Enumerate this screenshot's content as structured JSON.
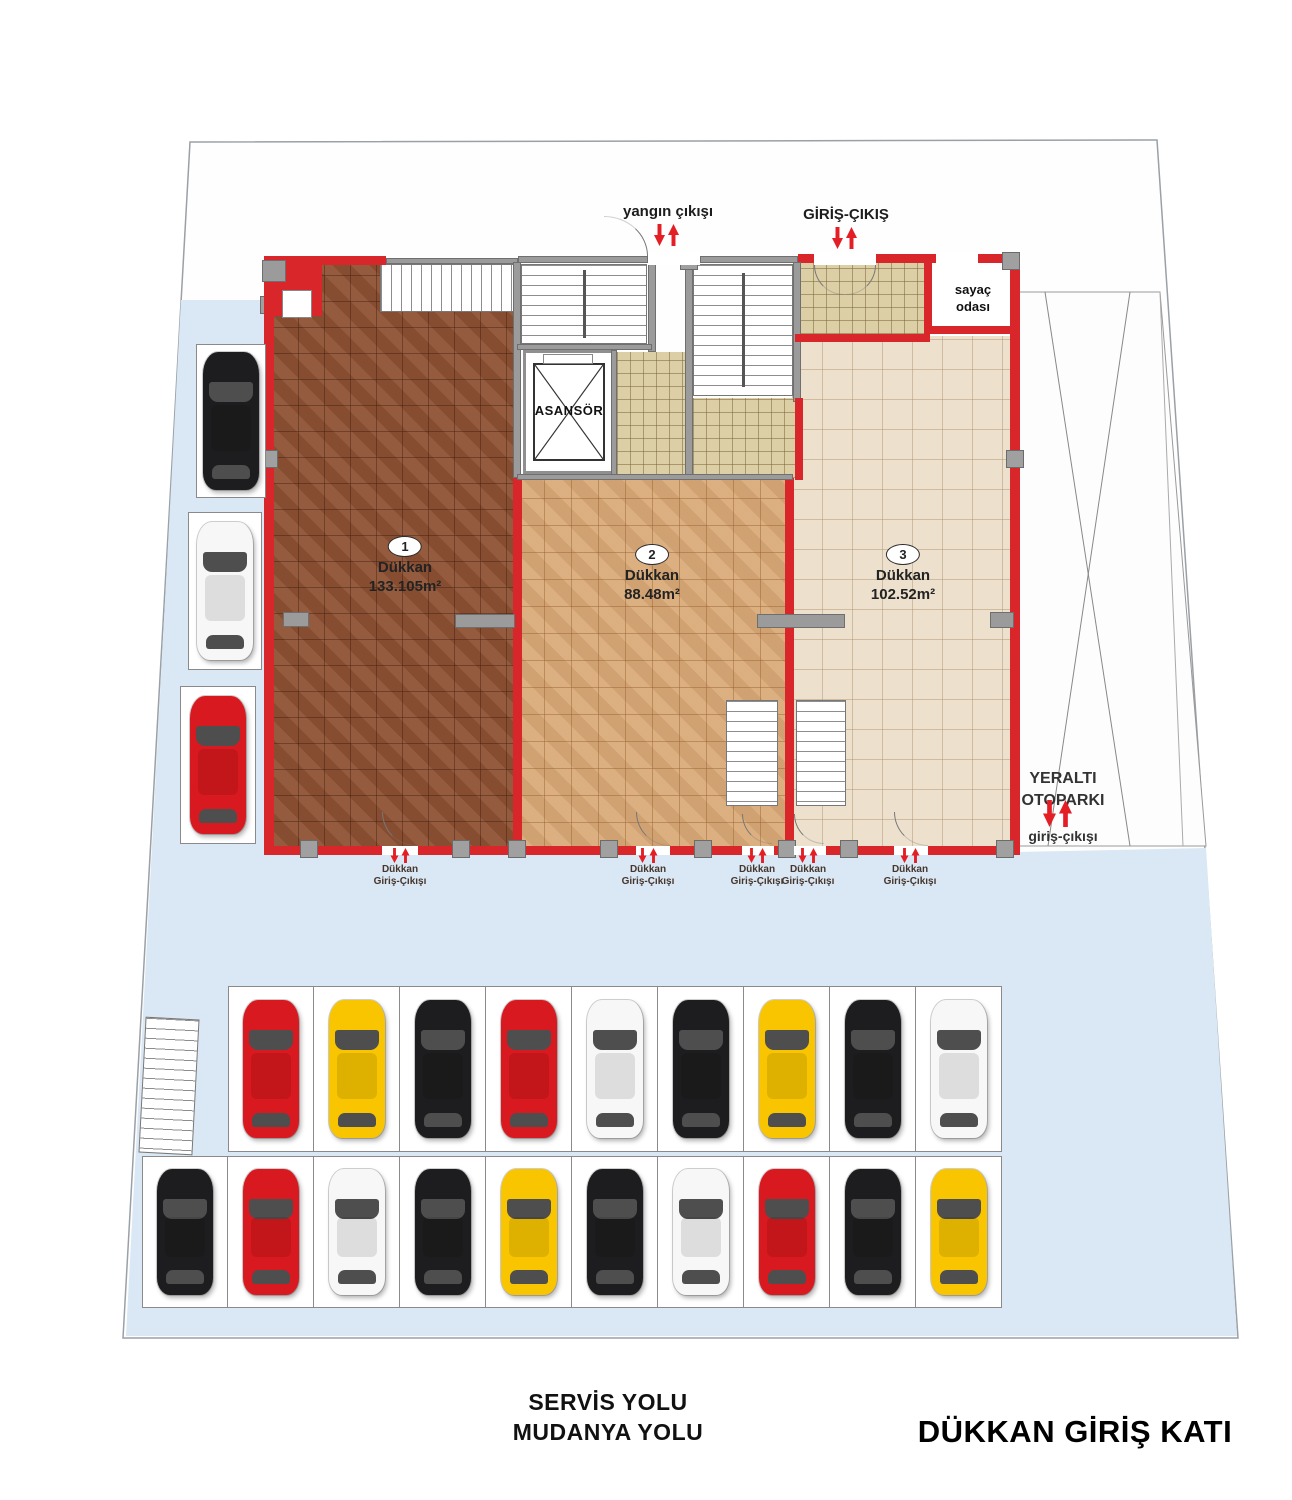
{
  "page": {
    "title": "DÜKKAN GİRİŞ KATI",
    "road_line1": "SERVİS YOLU",
    "road_line2": "MUDANYA YOLU"
  },
  "plan": {
    "fire_exit_label": "yangın çıkışı",
    "entrance_label": "GİRİŞ-ÇIKIŞ",
    "meter_room_line1": "sayaç",
    "meter_room_line2": "odası",
    "elevator_label": "ASANSÖR",
    "underground": {
      "line1": "YERALTI",
      "line2": "OTOPARKI",
      "line3": "giriş-çıkışı"
    },
    "shops": [
      {
        "number": "1",
        "type": "Dükkan",
        "area": "133.105m²"
      },
      {
        "number": "2",
        "type": "Dükkan",
        "area": "88.48m²"
      },
      {
        "number": "3",
        "type": "Dükkan",
        "area": "102.52m²"
      }
    ],
    "shop_entrance": {
      "line1": "Dükkan",
      "line2": "Giriş-Çıkışı"
    }
  },
  "parking": {
    "left_cars": [
      "black",
      "white",
      "red"
    ],
    "row1_cars": [
      "red",
      "yellow",
      "black",
      "red",
      "white",
      "black",
      "yellow",
      "black",
      "white"
    ],
    "row2_cars": [
      "black",
      "red",
      "white",
      "black",
      "yellow",
      "black",
      "white",
      "red",
      "black",
      "yellow"
    ]
  },
  "colors": {
    "road": "#d9e8f4",
    "wall_red": "#d8262b",
    "arrow_red": "#e31e25",
    "floor_shop1": "#8d5134",
    "floor_shop2": "#d8a877",
    "floor_shop3": "#ede1ce",
    "floor_hall": "#dccfa6",
    "car_red": "#d8191f",
    "car_yellow": "#f8c500",
    "car_black": "#1d1d1f",
    "car_white": "#f7f7f7"
  }
}
